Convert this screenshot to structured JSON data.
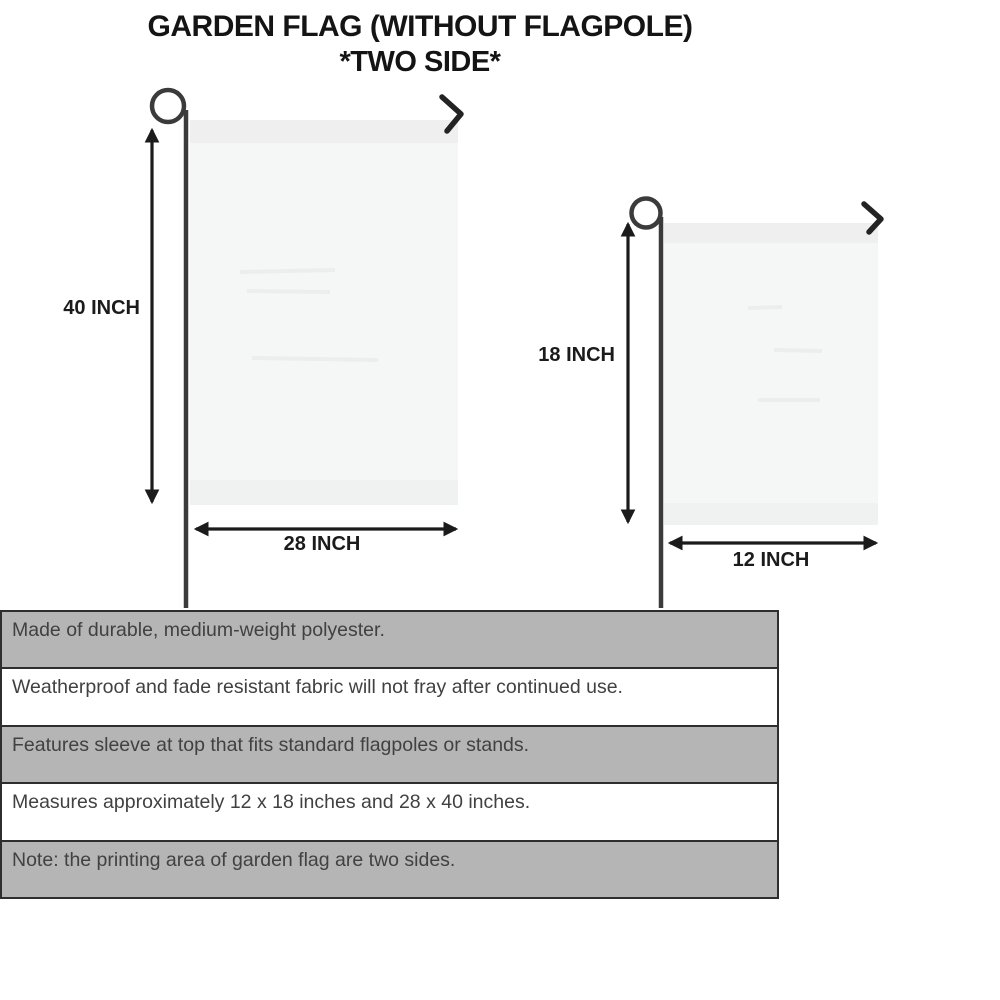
{
  "title": {
    "line1": "GARDEN FLAG (WITHOUT FLAGPOLE)",
    "line2": "*TWO SIDE*"
  },
  "diagram": {
    "large_flag": {
      "height_label": "40 INCH",
      "width_label": "28 INCH"
    },
    "small_flag": {
      "height_label": "18 INCH",
      "width_label": "12 INCH"
    }
  },
  "features": {
    "rows": [
      {
        "text": "Made of durable, medium-weight polyester."
      },
      {
        "text": "Weatherproof and fade resistant fabric will not fray after continued use."
      },
      {
        "text": "Features sleeve at top that fits standard flagpoles or stands."
      },
      {
        "text": "Measures approximately 12 x 18 inches and 28 x 40 inches."
      },
      {
        "text": "Note: the printing area of garden flag are two sides."
      }
    ]
  },
  "colors": {
    "row_shaded": "#b5b5b5",
    "row_border": "#2e2e2e",
    "flag_fill": "#f5f6f6",
    "flag_band": "#efefef",
    "pole": "#3b3b3b",
    "hook": "#232323",
    "arrow": "#1b1b1b",
    "body_text": "#414141",
    "title_text": "#141414"
  }
}
